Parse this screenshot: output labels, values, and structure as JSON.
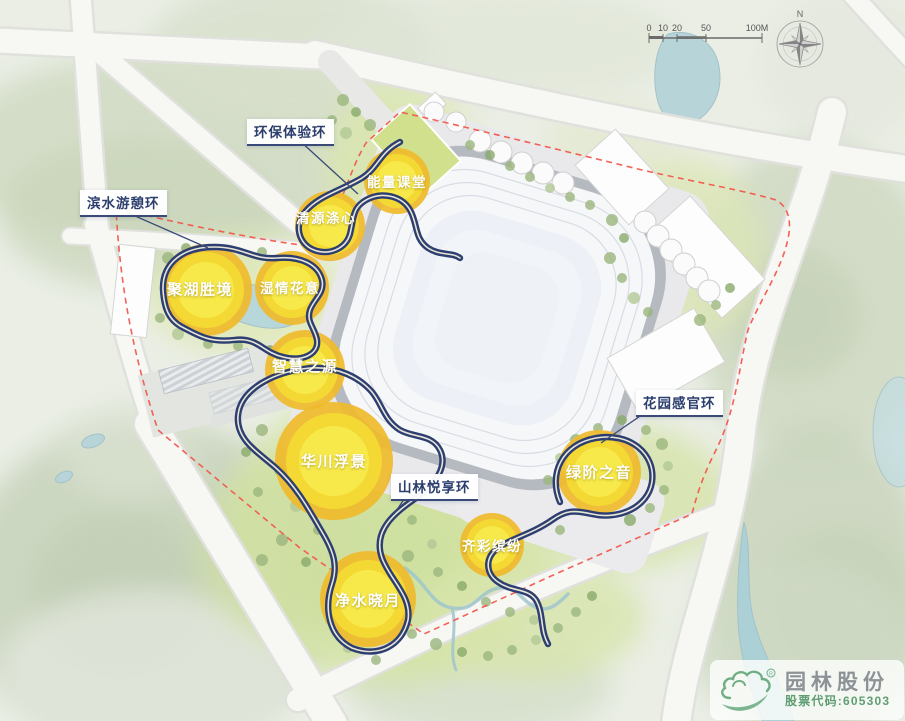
{
  "map": {
    "ring_labels": [
      {
        "id": "eco",
        "text": "环保体验环"
      },
      {
        "id": "waterfront",
        "text": "滨水游憩环"
      },
      {
        "id": "mountain",
        "text": "山林悦享环"
      },
      {
        "id": "garden",
        "text": "花园感官环"
      }
    ],
    "nodes": [
      {
        "id": "energy",
        "text": "能量课堂"
      },
      {
        "id": "qingyuan",
        "text": "清源涤心"
      },
      {
        "id": "juhu",
        "text": "聚湖胜境"
      },
      {
        "id": "shiqing",
        "text": "湿情花意"
      },
      {
        "id": "zhihui",
        "text": "智慧之源"
      },
      {
        "id": "huachuan",
        "text": "华川浮景"
      },
      {
        "id": "jingshui",
        "text": "净水晓月"
      },
      {
        "id": "lvjie",
        "text": "绿阶之音"
      },
      {
        "id": "qicai",
        "text": "齐彩缤纷"
      }
    ]
  },
  "scale_bar": {
    "ticks": [
      "0",
      "10",
      "20",
      "50",
      "100M"
    ]
  },
  "compass": {
    "north": "N"
  },
  "logo": {
    "name": "园林股份",
    "stock_code": "股票代码:605303",
    "registered_mark": "R"
  },
  "colors": {
    "ring_path": "#2d3e70",
    "ring_stripe": "#e9e6d8",
    "node_ring": "#efba2c",
    "node_fill": "#f7ea4b",
    "boundary": "#f2594e",
    "water": "#b7d4d9",
    "label_text": "#2c3e6e",
    "logo_green": "#6fae84"
  }
}
